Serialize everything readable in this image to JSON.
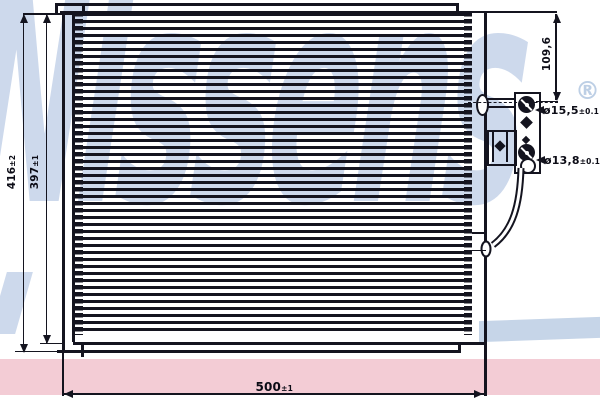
{
  "watermark": {
    "text": "Nissens",
    "registered": "®"
  },
  "labels": {
    "overall_height": {
      "value": "416",
      "tol": "±2"
    },
    "core_height": {
      "value": "397",
      "tol": "±1"
    },
    "overall_width": {
      "value": "500",
      "tol": "±1"
    },
    "port_height": {
      "value": "109,6"
    },
    "top_port_diameter": {
      "value": "ø15,5",
      "tol": "±0.1"
    },
    "bottom_port_diameter": {
      "value": "ø13,8",
      "tol": "±0.1"
    }
  },
  "colors": {
    "line": "#14141f",
    "watermark_blue": "#cdd9ec",
    "swoosh_blue": "#c6d5e8",
    "band_pink": "#f3ccd5",
    "background": "#ffffff"
  }
}
